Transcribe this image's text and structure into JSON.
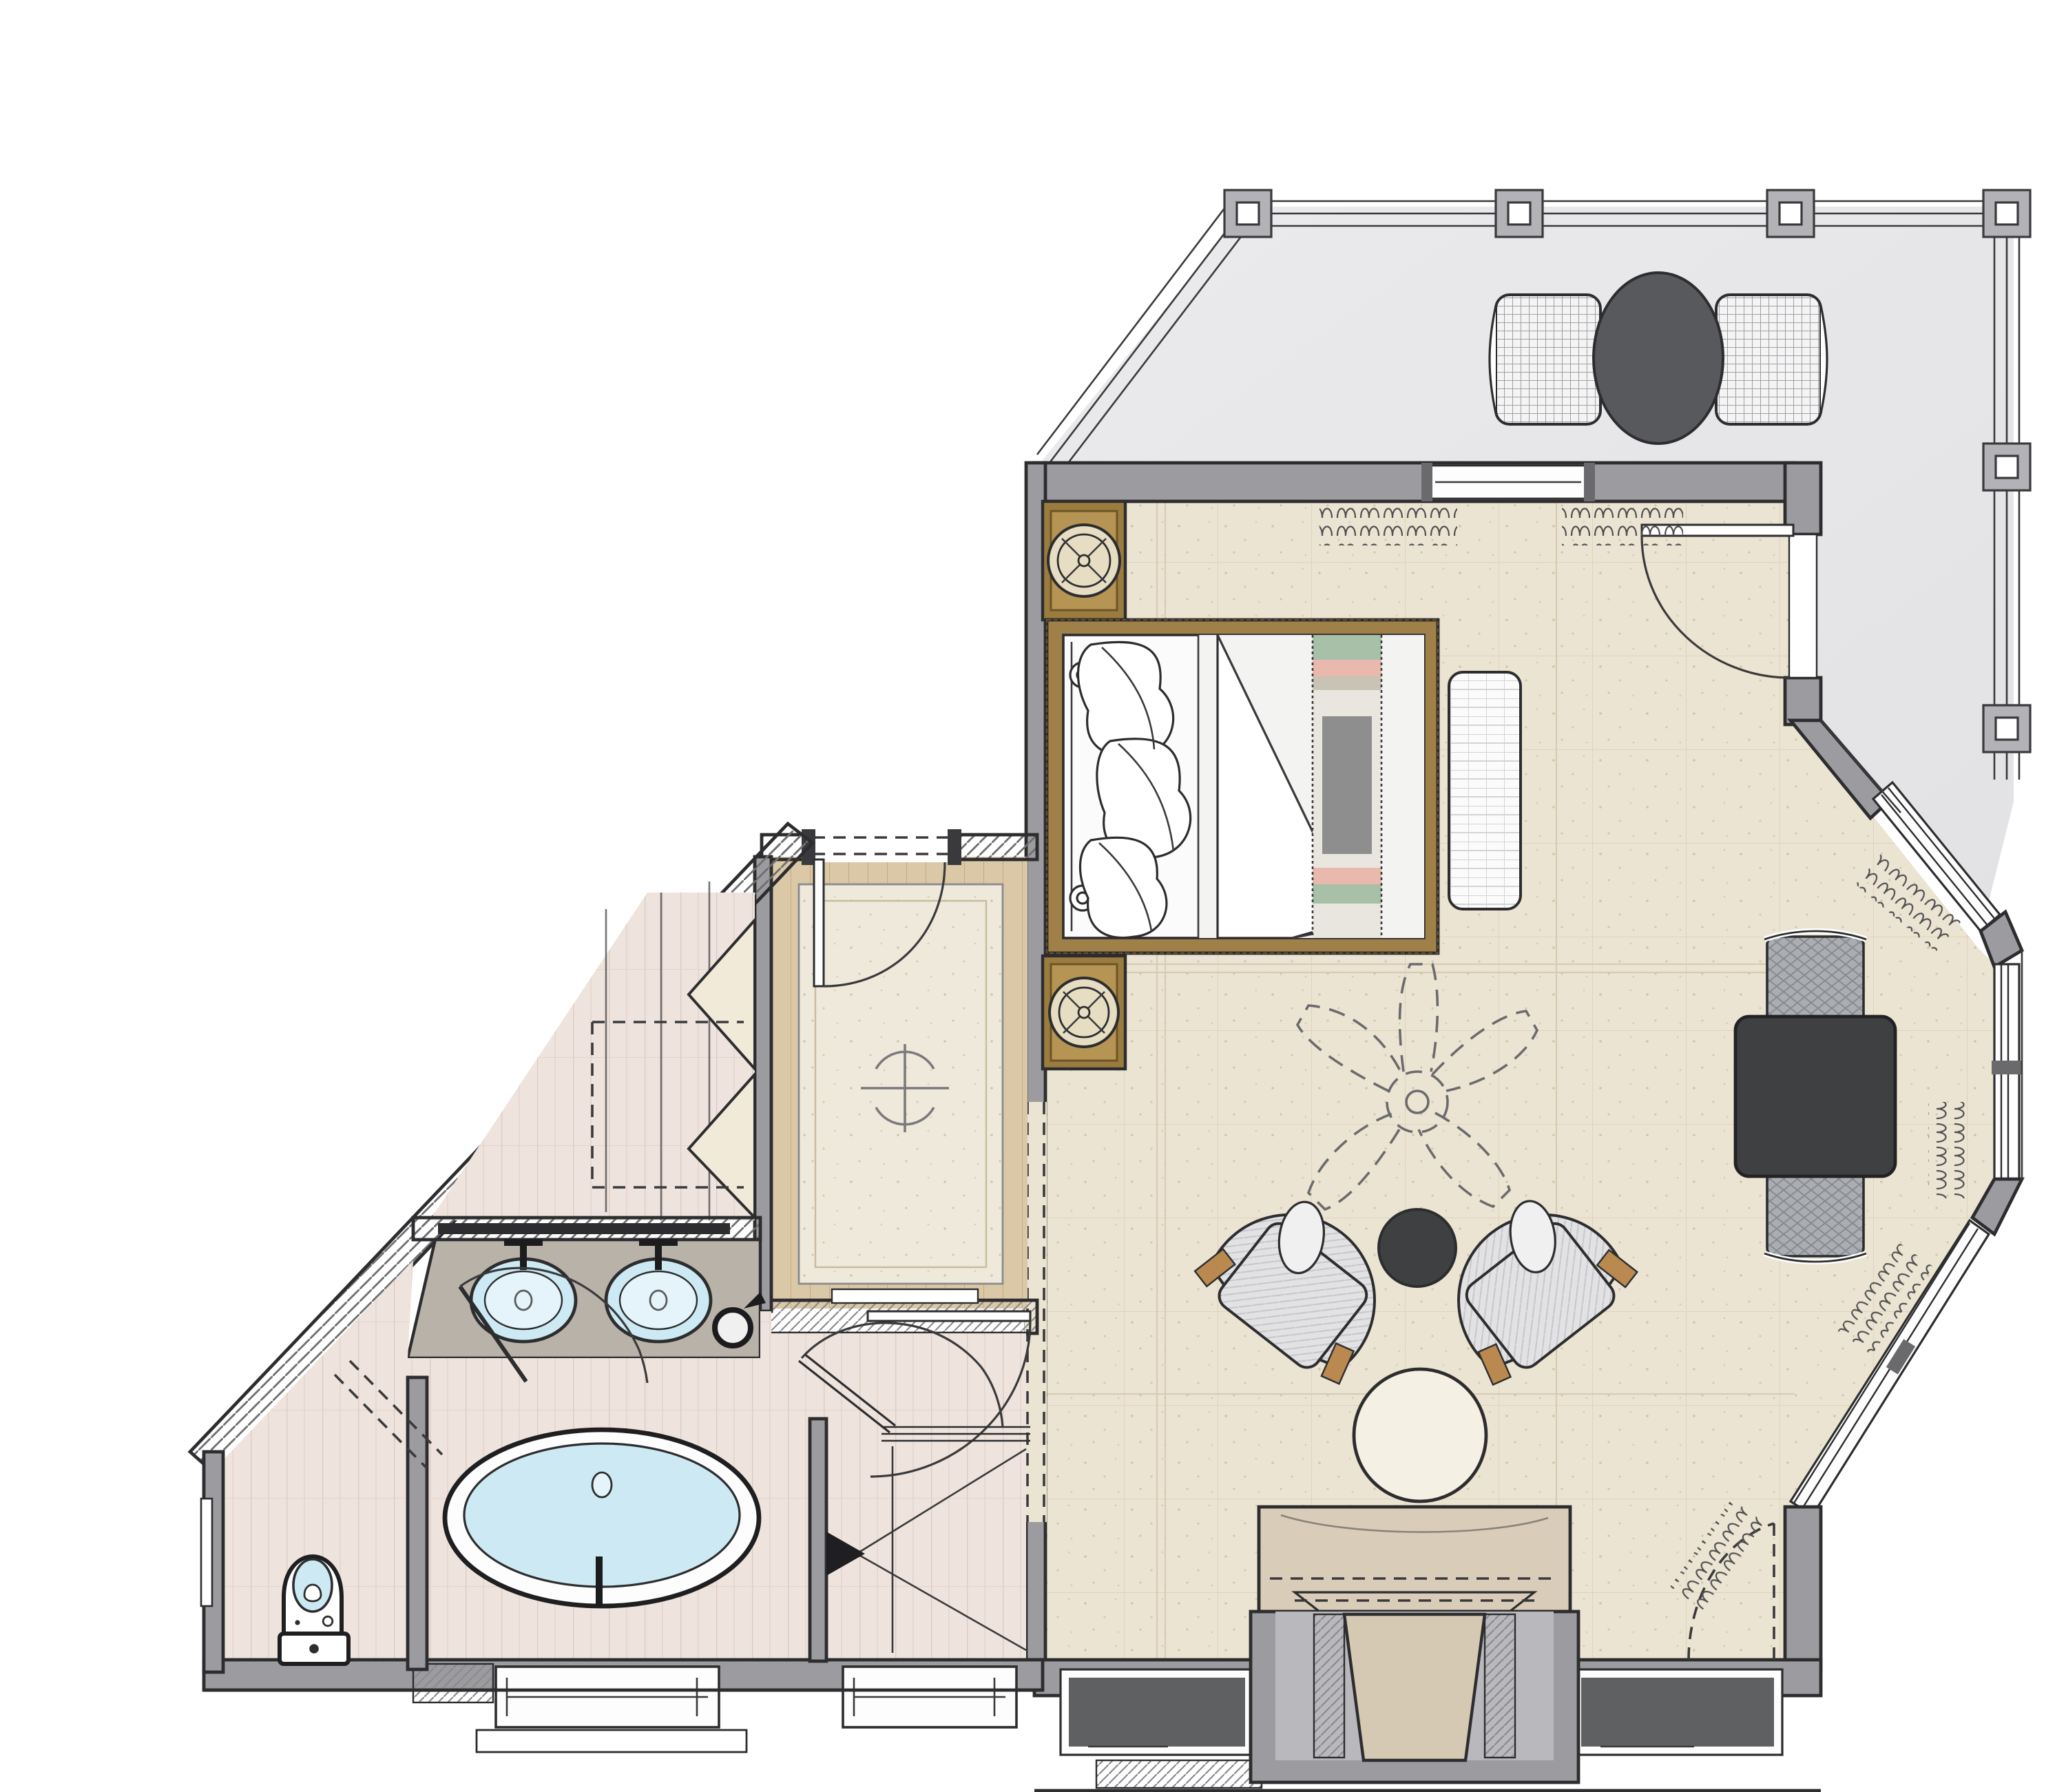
{
  "document": {
    "type": "floor-plan",
    "view": "top-down interior design rendering",
    "text_labels": [],
    "rooms": [
      {
        "id": "deck",
        "name": "outdoor deck",
        "features": [
          "perimeter railing",
          "6 square posts",
          "round bistro table",
          "2 mesh curved benches"
        ]
      },
      {
        "id": "bedroom",
        "name": "master bedroom",
        "features": [
          "king bed with gold woven frame",
          "2 bronze nightstands with round lamps",
          "woven bench at bedside",
          "ceiling fan (dashed symbol)",
          "2 barrel lounge chairs",
          "round dark side table",
          "round cream ottoman",
          "dark square table with 2 upholstered drum stools",
          "stone console with stool niche",
          "glass door to deck",
          "bay windows with drapery marks",
          "cased opening (dashed) to vestibule"
        ]
      },
      {
        "id": "vestibule",
        "name": "entry vestibule",
        "features": [
          "entry door",
          "bordered area rug",
          "ceiling light symbol",
          "hatched threshold"
        ]
      },
      {
        "id": "closet",
        "name": "closet",
        "features": [
          "chevron bifold doors",
          "dashed shelf outline"
        ]
      },
      {
        "id": "bathroom",
        "name": "master bathroom",
        "features": [
          "double vanity with 2 oval sinks",
          "mirror",
          "hair dryer",
          "freestanding oval tub",
          "2 bottom windows",
          "entry swing door"
        ]
      },
      {
        "id": "shower",
        "name": "walk-in shower",
        "features": [
          "glass panel and door",
          "X floor marker",
          "entry arrow"
        ]
      },
      {
        "id": "wc",
        "name": "water closet",
        "features": [
          "toilet",
          "pocket door (dashed)",
          "wall niche",
          "angled exterior wall"
        ]
      }
    ],
    "counts": {
      "deck_posts": 6,
      "sinks": 2,
      "lounge_chairs": 2,
      "drum_stools": 2,
      "deck_benches": 2,
      "nightstands": 2,
      "bottom_windows_bedroom": 2,
      "bottom_windows_bath": 2
    }
  },
  "colors": {
    "paper": "#ffffff",
    "wall_fill": "#9c9ca0",
    "wall_line": "#2d2d2f",
    "deck_floor": "#e7e7e9",
    "deck_rail": "#8f8f93",
    "post_fill": "#b3b3b7",
    "bedroom_floor": "#ece4d2",
    "bath_floor": "#efe4dd",
    "vest_wood": "#dbc8a6",
    "rug": "#efe9db",
    "gold": "#a08049",
    "gold_dark": "#6e5426",
    "bronze": "#9b7c3f",
    "lamp_cream": "#e6ddc2",
    "fixture_blue": "#cdeaf4",
    "fixture_blue_lt": "#e4f4fa",
    "dark_table": "#3f4042",
    "deck_table": "#58595c",
    "drum": "#aaaeb2",
    "chair": "#e2e2e4",
    "chair_trim": "#b9894f",
    "ottoman": "#f4f0e3",
    "console_stone": "#d9cdb9",
    "stool": "#d5c9b4",
    "window_dark": "#5e6062",
    "counter_stone": "#b8b2a9",
    "white": "#fdfdfd"
  }
}
